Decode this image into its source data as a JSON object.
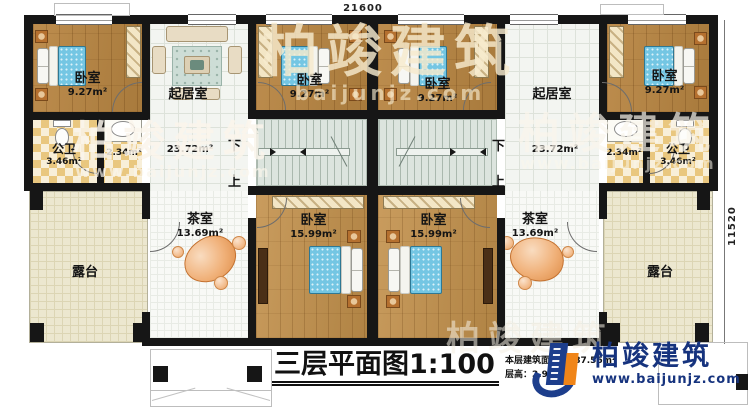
{
  "dimensions": {
    "width_top": "21600",
    "height_right": "11520"
  },
  "labels": {
    "bedroom_small_name": "卧室",
    "bedroom_small_area": "9.27m²",
    "living_name": "起居室",
    "living_area": "23.72m²",
    "bath_name": "公卫",
    "bath_area": "3.46m²",
    "wash_area": "2.34m²",
    "bedroom_large_name": "卧室",
    "bedroom_large_area": "15.99m²",
    "tea_name": "茶室",
    "tea_area": "13.69m²",
    "terrace_name": "露台",
    "stair_down": "下",
    "stair_up": "上"
  },
  "title": {
    "text": "三层平面图",
    "scale": "1:100",
    "area_line": "本层建筑面积：187.56m²",
    "height_line": "层高：2.9m"
  },
  "brand": {
    "name": "柏竣建筑",
    "url": "www.baijunjz.com"
  },
  "watermark": {
    "name": "柏竣建筑",
    "url": "www.baijunjz.com",
    "short": "baijunjz.com"
  },
  "colors": {
    "brand_navy": "#16337e",
    "brand_orange": "#f08519",
    "wall": "#161616"
  }
}
